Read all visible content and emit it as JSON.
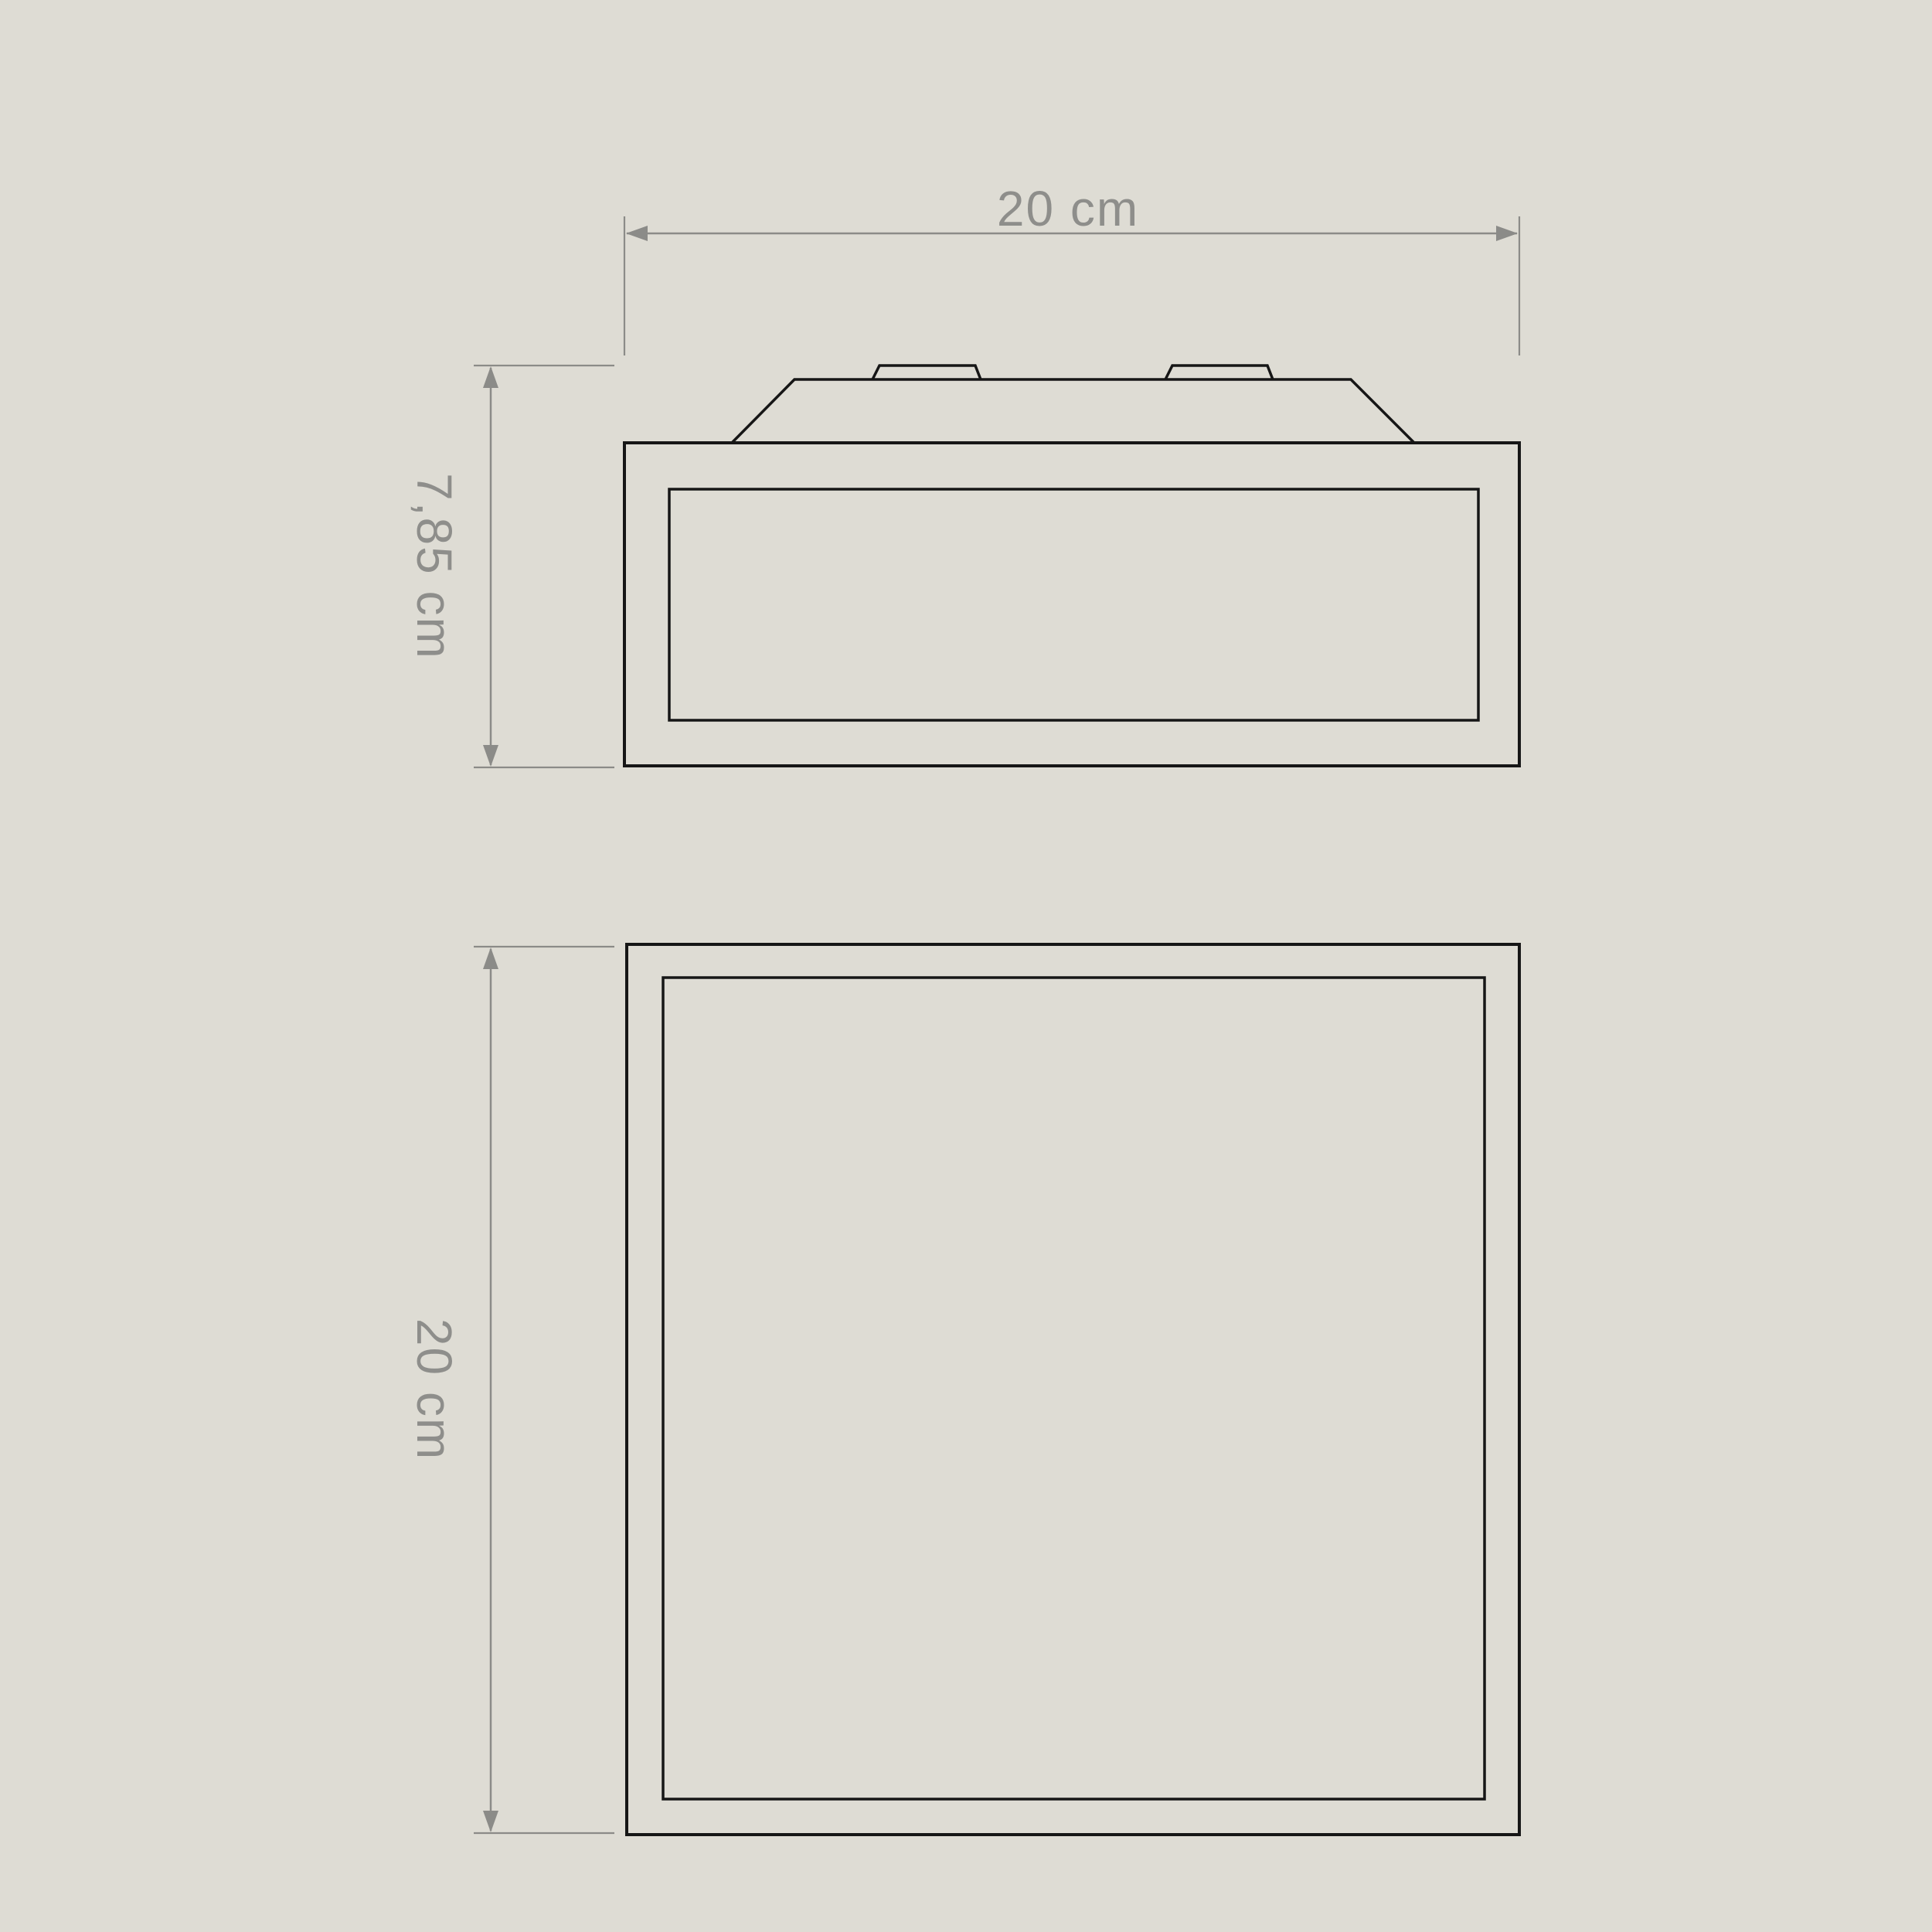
{
  "page": {
    "background_color": "#dedcd4"
  },
  "drawing": {
    "outline_color": "#161616",
    "dimension_color": "#8b8b88",
    "views": {
      "front_elevation": {
        "width_label": "20 cm",
        "height_label": "7,85 cm"
      },
      "plan_view": {
        "depth_label": "20 cm"
      }
    }
  },
  "dimensions": {
    "width": {
      "label": "20 cm",
      "orientation": "horizontal"
    },
    "height": {
      "label": "7,85 cm",
      "orientation": "vertical"
    },
    "depth": {
      "label": "20 cm",
      "orientation": "vertical"
    }
  }
}
